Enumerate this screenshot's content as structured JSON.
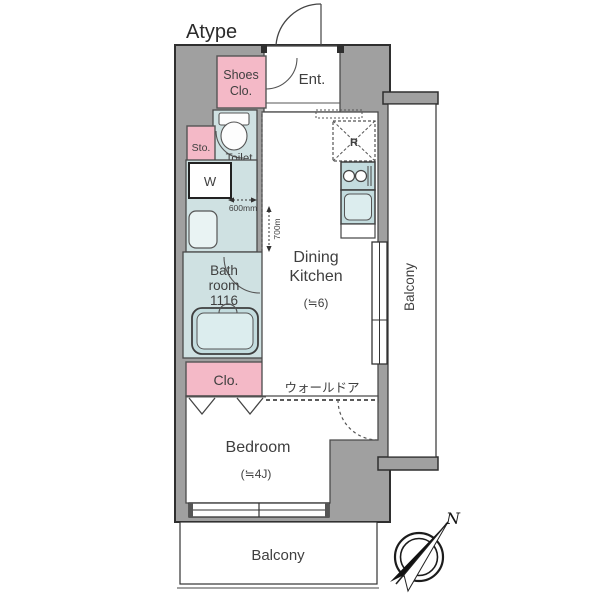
{
  "plan": {
    "title": "Atype",
    "labels": {
      "ent": "Ent.",
      "shoes_line1": "Shoes",
      "shoes_line2": "Clo.",
      "sto": "Sto.",
      "toilet": "Toilet",
      "washer": "W",
      "bath_line1": "Bath",
      "bath_line2": "room",
      "bath_line3": "1116",
      "closet": "Clo.",
      "dk_line1": "Dining",
      "dk_line2": "Kitchen",
      "dk_size": "(≒6)",
      "bedroom": "Bedroom",
      "bedroom_size": "(≒4J)",
      "balcony_right": "Balcony",
      "balcony_bottom": "Balcony",
      "wall_door": "ウォールドア",
      "fridge": "R",
      "north": "N"
    },
    "dimensions": {
      "corridor_width": "600mm",
      "corridor_depth": "700m"
    },
    "colors": {
      "wall": "#a0a0a0",
      "wet": "#cfe1e2",
      "wet_dark": "#c3dcde",
      "wet_light": "#dcedee",
      "pink": "#f4b9c7",
      "white": "#ffffff",
      "outline": "#4a4a4a"
    }
  }
}
